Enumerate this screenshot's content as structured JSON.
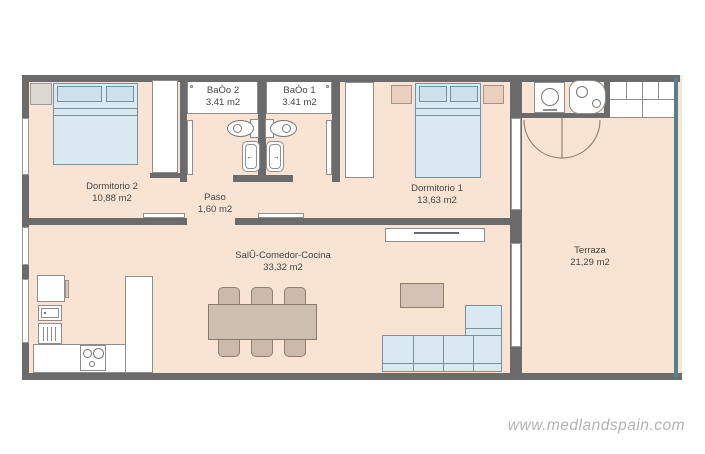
{
  "watermark": "www.medlandspain.com",
  "rooms": {
    "dormitorio2": {
      "name": "Dormitorio 2",
      "area": "10,88 m2"
    },
    "bano2": {
      "name": "BaÒo 2",
      "area": "3.41 m2"
    },
    "bano1": {
      "name": "BaÒo 1",
      "area": "3.41 m2"
    },
    "dormitorio1": {
      "name": "Dormitorio 1",
      "area": "13,63 m2"
    },
    "paso": {
      "name": "Paso",
      "area": "1,60 m2"
    },
    "salon": {
      "name": "SalÛ-Comedor-Cocina",
      "area": "33,32 m2"
    },
    "terraza": {
      "name": "Terraza",
      "area": "21,29 m2"
    }
  },
  "colors": {
    "wall": "#6b6b6b",
    "floor": "#f9e4d4",
    "furniture_blue": "#d9e8f1",
    "furniture_beige": "#cbbaaa",
    "terraza_railing": "#56808e",
    "door_arc": "#9c7e67",
    "watermark_gray": "#b3b3b3"
  }
}
